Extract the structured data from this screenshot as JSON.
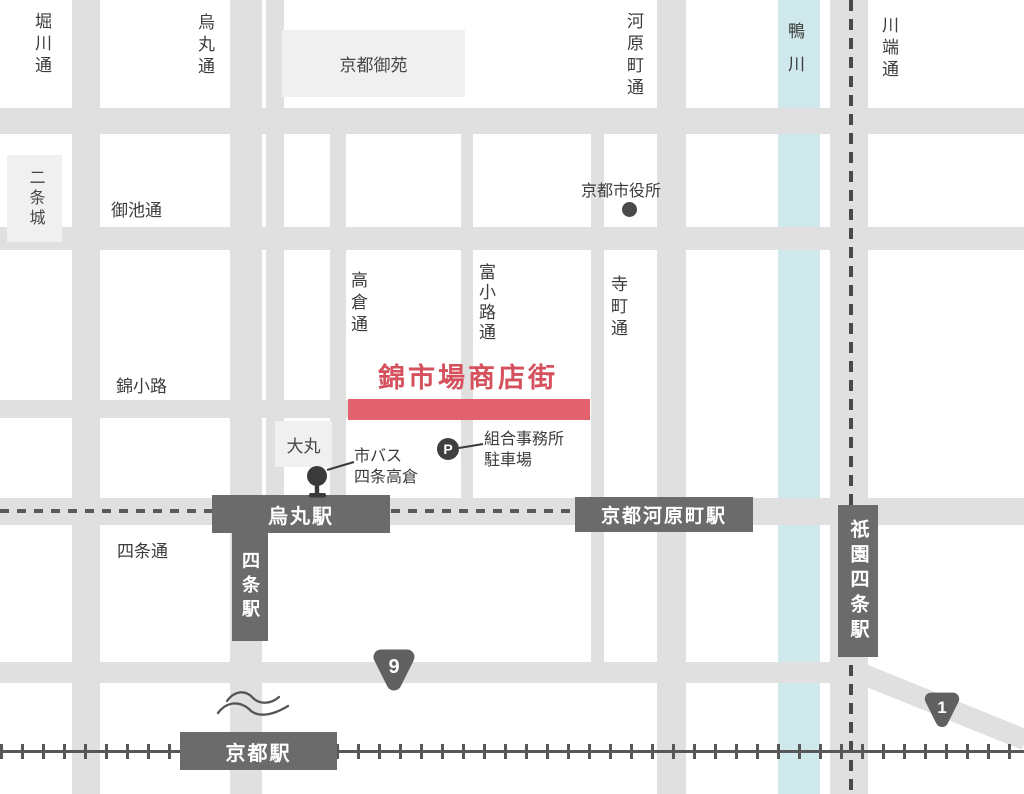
{
  "map": {
    "title": "錦市場商店街",
    "river": {
      "label": "鴨川"
    },
    "streets": {
      "horikawa": "堀川通",
      "karasuma": "烏丸通",
      "kawaramachi": "河原町通",
      "kawabata": "川端通",
      "oike": "御池通",
      "takakura": "高倉通",
      "tominokoji": "富小路通",
      "teramachi": "寺町通",
      "nishikikoji": "錦小路",
      "shijo": "四条通"
    },
    "places": {
      "gyoen": "京都御苑",
      "nijo_castle": "二条城",
      "daimaru": "大丸",
      "city_hall": "京都市役所"
    },
    "stations": {
      "karasuma": "烏丸駅",
      "kyoto_kawaramachi": "京都河原町駅",
      "gion_shijo": "祇園四条駅",
      "shijo": "四条駅",
      "kyoto": "京都駅"
    },
    "pois": {
      "bus_stop": {
        "line1": "市バス",
        "line2": "四条高倉"
      },
      "parking": {
        "mark": "P",
        "line1": "組合事務所",
        "line2": "駐車場"
      }
    },
    "badges": {
      "route9": "9",
      "route1": "1"
    },
    "colors": {
      "road": "#e0e0e0",
      "river": "#cfe8ec",
      "market_bar": "#e2636e",
      "title_red": "#d4515d",
      "station_dark": "#6b6b6b",
      "rail_dark": "#575757",
      "block_light": "#f0f0f0"
    }
  }
}
